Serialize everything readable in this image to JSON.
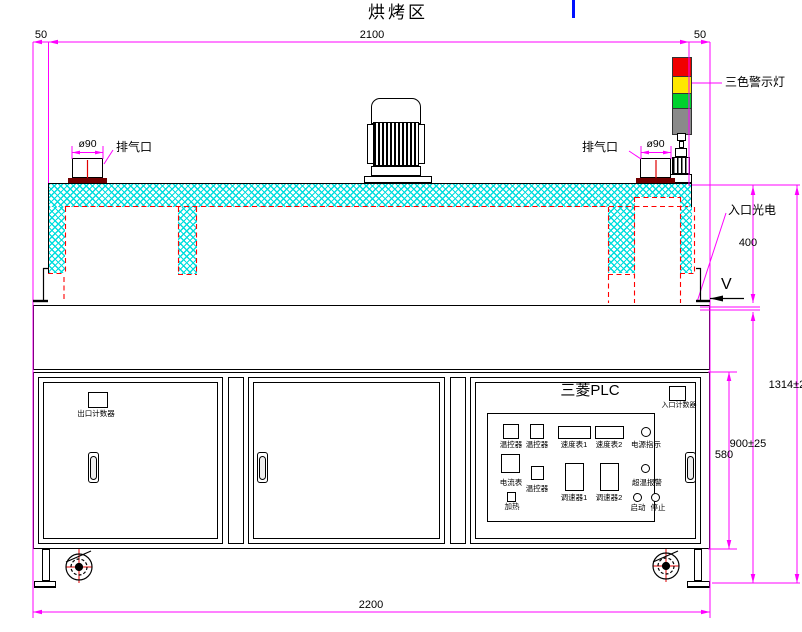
{
  "title": "烘烤区",
  "dims": {
    "left50": "50",
    "top2100": "2100",
    "right50": "50",
    "dia_left": "ø90",
    "dia_right": "ø90",
    "height400": "400",
    "height1314": "1314±25",
    "height900": "900±25",
    "height580": "580",
    "bottom2200": "2200"
  },
  "labels": {
    "exhaust_left": "排气口",
    "exhaust_right": "排气口",
    "tower_light": "三色警示灯",
    "inlet_sensor": "入口光电",
    "belt_direction": "V",
    "exit_counter": "出口计数器",
    "entry_counter": "入口计数器",
    "plc_title": "三菱PLC"
  },
  "panel": {
    "row1": [
      {
        "label": "温控器"
      },
      {
        "label": "温控器"
      },
      {
        "label": "速度表1"
      },
      {
        "label": "速度表2"
      },
      {
        "label": "电源指示"
      }
    ],
    "row2": [
      {
        "label": "电流表"
      },
      {
        "label": "温控器"
      },
      {
        "label": "调速器1"
      },
      {
        "label": "调速器2"
      },
      {
        "label": "超温报警"
      }
    ],
    "row3": [
      {
        "label": "加热"
      },
      {
        "label": "启动"
      },
      {
        "label": "停止"
      }
    ]
  },
  "colors": {
    "dimension": "#FF00FF",
    "hidden_line": "#FF0000",
    "hatch": "#00DEDE",
    "tower_red": "#F00000",
    "tower_yellow": "#FFE800",
    "tower_green": "#00D22D",
    "tower_gray": "#8A8A8A",
    "cursor_blue": "#0010FF"
  }
}
